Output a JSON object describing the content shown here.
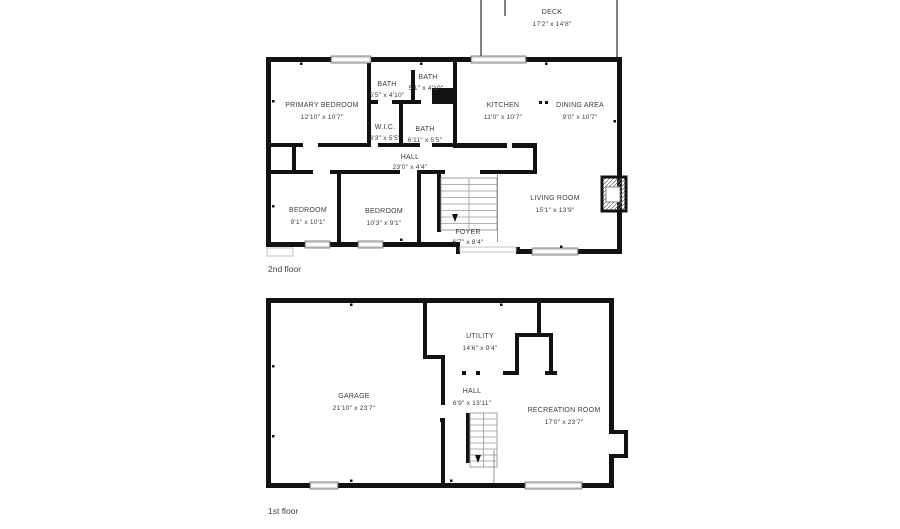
{
  "page": {
    "background": "#ffffff"
  },
  "colors": {
    "wall": "#121212",
    "window": "#d9d9d9",
    "stair_line": "#9a9a9a",
    "label_text": "#3c3c3c"
  },
  "floors": [
    {
      "label": "2nd floor",
      "rooms": [
        {
          "name": "DECK",
          "dims": "17'2\" x 14'8\""
        },
        {
          "name": "PRIMARY BEDROOM",
          "dims": "12'10\" x 10'7\""
        },
        {
          "name": "BATH",
          "dims": "5'5\" x 4'10\""
        },
        {
          "name": "BATH",
          "dims": "5'1\" x 4'10\""
        },
        {
          "name": "KITCHEN",
          "dims": "11'0\" x 10'7\""
        },
        {
          "name": "DINING AREA",
          "dims": "9'0\" x 10'7\""
        },
        {
          "name": "W.I.C.",
          "dims": "3'3\" x 5'5\""
        },
        {
          "name": "BATH",
          "dims": "6'11\" x 5'5\""
        },
        {
          "name": "HALL",
          "dims": "23'0\" x 4'4\""
        },
        {
          "name": "BEDROOM",
          "dims": "9'1\" x 10'1\""
        },
        {
          "name": "BEDROOM",
          "dims": "10'3\" x 9'1\""
        },
        {
          "name": "FOYER",
          "dims": "6'7\" x 8'4\""
        },
        {
          "name": "LIVING ROOM",
          "dims": "15'1\" x 13'9\""
        }
      ]
    },
    {
      "label": "1st floor",
      "rooms": [
        {
          "name": "UTILITY",
          "dims": "14'6\" x 9'4\""
        },
        {
          "name": "GARAGE",
          "dims": "21'10\" x 23'7\""
        },
        {
          "name": "HALL",
          "dims": "6'9\" x 13'11\""
        },
        {
          "name": "RECREATION ROOM",
          "dims": "17'0\" x 23'7\""
        }
      ]
    }
  ]
}
